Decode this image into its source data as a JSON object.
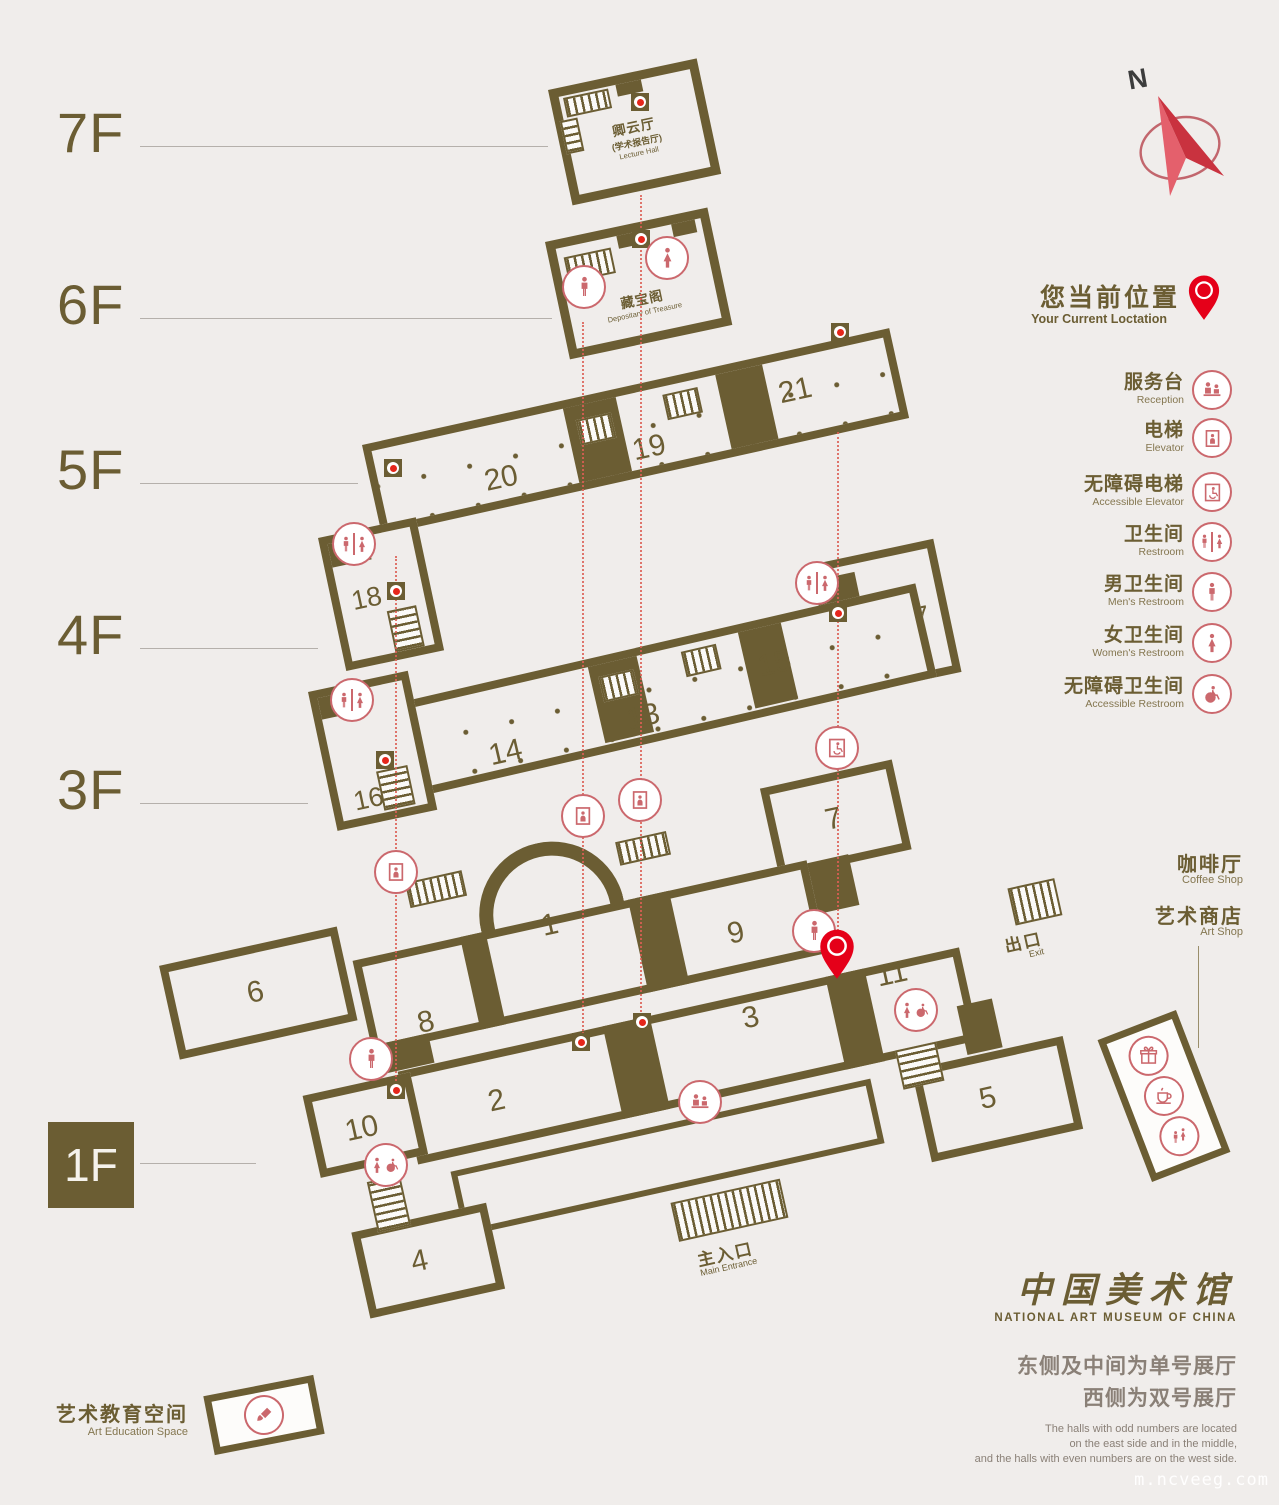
{
  "compass": {
    "label": "N"
  },
  "current_location": {
    "zh": "您当前位置",
    "en": "Your Current Loctation"
  },
  "legend": [
    {
      "zh": "服务台",
      "en": "Reception",
      "icon": "reception"
    },
    {
      "zh": "电梯",
      "en": "Elevator",
      "icon": "elevator"
    },
    {
      "zh": "无障碍电梯",
      "en": "Accessible Elevator",
      "icon": "accessible-elevator"
    },
    {
      "zh": "卫生间",
      "en": "Restroom",
      "icon": "restroom"
    },
    {
      "zh": "男卫生间",
      "en": "Men's Restroom",
      "icon": "mens-restroom"
    },
    {
      "zh": "女卫生间",
      "en": "Women's Restroom",
      "icon": "womens-restroom"
    },
    {
      "zh": "无障碍卫生间",
      "en": "Accessible Restroom",
      "icon": "accessible-restroom"
    }
  ],
  "floors": {
    "f7": {
      "label": "7F",
      "hall_zh": "卿云厅",
      "hall_sub": "(学术报告厅)",
      "hall_en": "Lecture Hall"
    },
    "f6": {
      "label": "6F",
      "hall_zh": "藏宝阁",
      "hall_en": "Depositary of Treasure"
    },
    "f5": {
      "label": "5F",
      "halls": [
        "19",
        "20",
        "21"
      ]
    },
    "f4": {
      "label": "4F",
      "halls": [
        "17",
        "18"
      ]
    },
    "f3": {
      "label": "3F",
      "halls": [
        "13",
        "14",
        "15",
        "16"
      ]
    },
    "f1": {
      "label": "1F",
      "halls": [
        "1",
        "2",
        "3",
        "4",
        "5",
        "6",
        "7",
        "8",
        "9",
        "10",
        "11"
      ],
      "entrance_zh": "主入口",
      "entrance_en": "Main Entrance",
      "exit_zh": "出口",
      "exit_en": "Exit"
    }
  },
  "amenities": {
    "coffee": {
      "zh": "咖啡厅",
      "en": "Coffee Shop"
    },
    "art_shop": {
      "zh": "艺术商店",
      "en": "Art Shop"
    },
    "art_education": {
      "zh": "艺术教育空间",
      "en": "Art Education Space"
    }
  },
  "footer": {
    "logo_zh": "中国美术馆",
    "logo_en": "NATIONAL ART MUSEUM OF CHINA",
    "note_zh_1": "东侧及中间为单号展厅",
    "note_zh_2": "西侧为双号展厅",
    "note_en_1": "The halls with odd numbers are located",
    "note_en_2": "on the east side and in the middle,",
    "note_en_3": "and the halls with even numbers are on the west side."
  },
  "watermark": "m.ncveeg.com",
  "colors": {
    "wall": "#6b5d33",
    "background": "#f0edeb",
    "accent_red": "#e50019",
    "icon_red": "#cb686d"
  }
}
